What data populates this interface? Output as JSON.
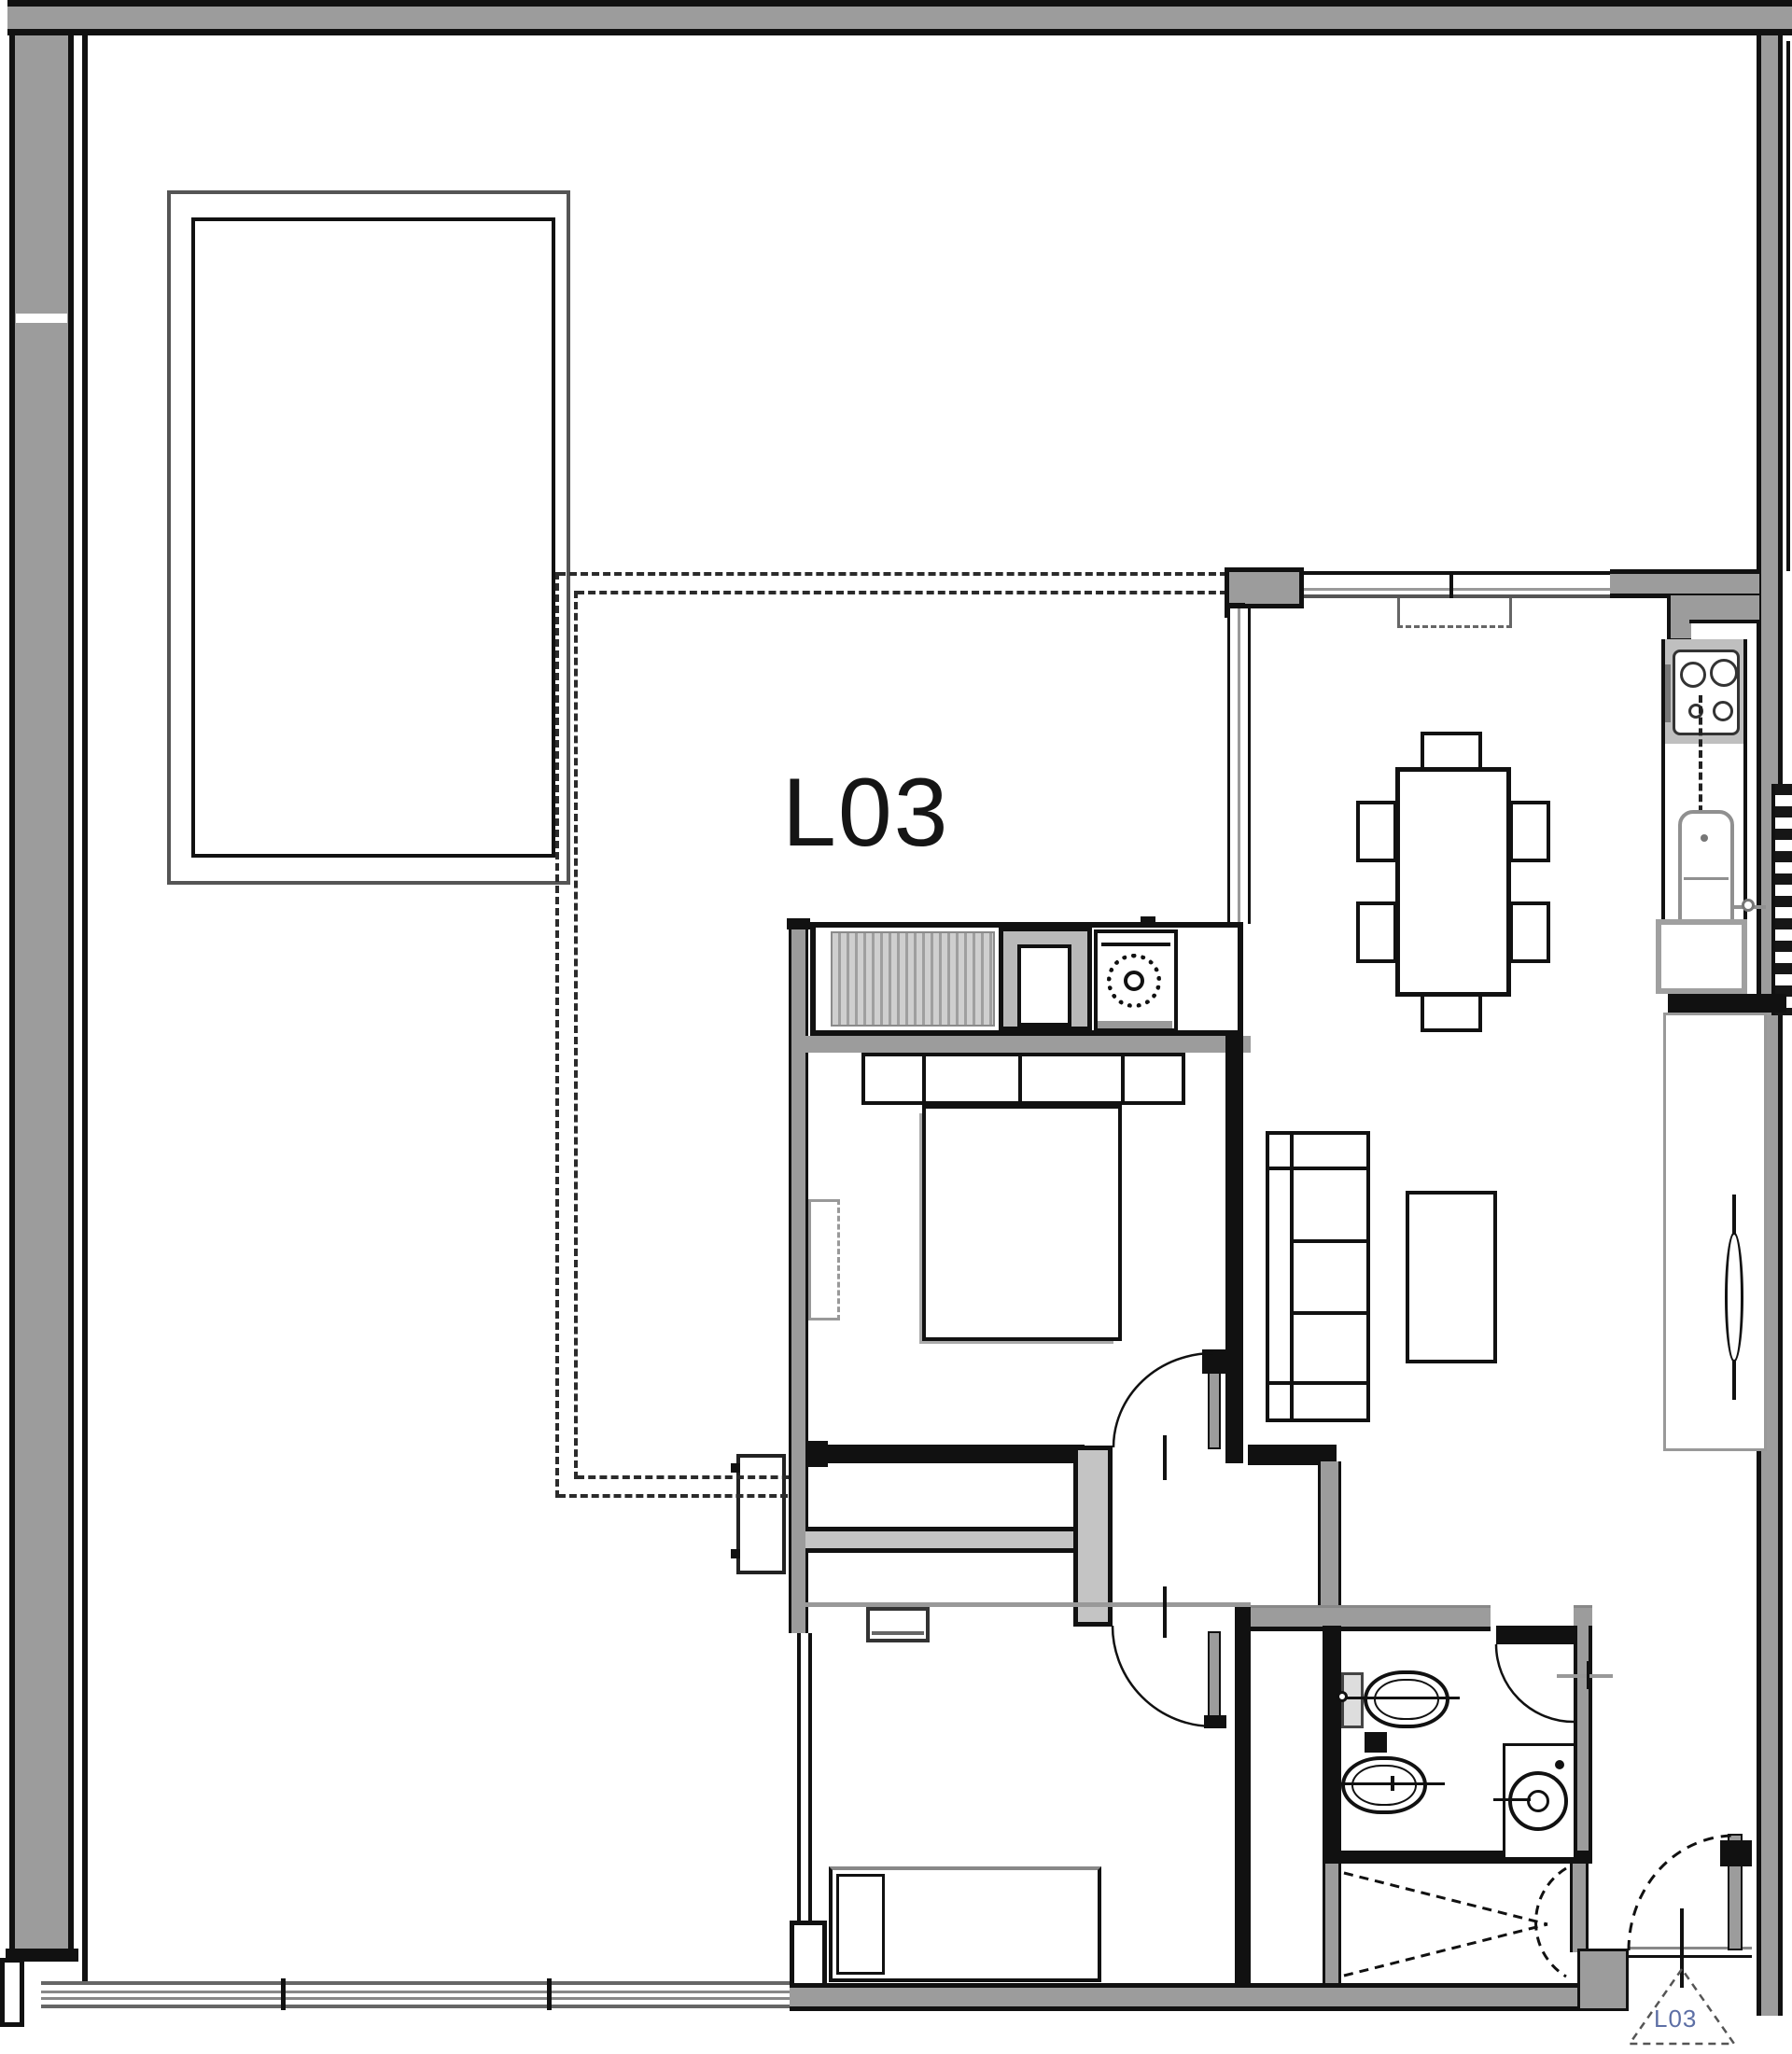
{
  "plan": {
    "unit_label": "L03",
    "entry_marker_label": "L03"
  },
  "colors": {
    "wall_fill": "#9c9c9c",
    "line": "#111111",
    "furn_gray": "#c4c4c4",
    "soft_gray": "#999999",
    "bg": "#ffffff",
    "label": "#151515",
    "entry_label": "#5d6fa5"
  },
  "fixtures": [
    "terrace-pool",
    "dashed-projection-outline",
    "dining-table",
    "dining-chair",
    "sofa",
    "coffee-table",
    "cooktop",
    "kitchen-counter",
    "kitchen-sink",
    "refrigerator",
    "tall-cabinet",
    "pivot-door",
    "wardrobe-hatched",
    "utility-cabinet",
    "washing-machine",
    "double-bed",
    "headboard",
    "single-bed",
    "pillow",
    "toilet",
    "bidet",
    "washbasin",
    "interior-door",
    "entry-door",
    "closet-x",
    "entry-triangle-marker",
    "window-band"
  ]
}
